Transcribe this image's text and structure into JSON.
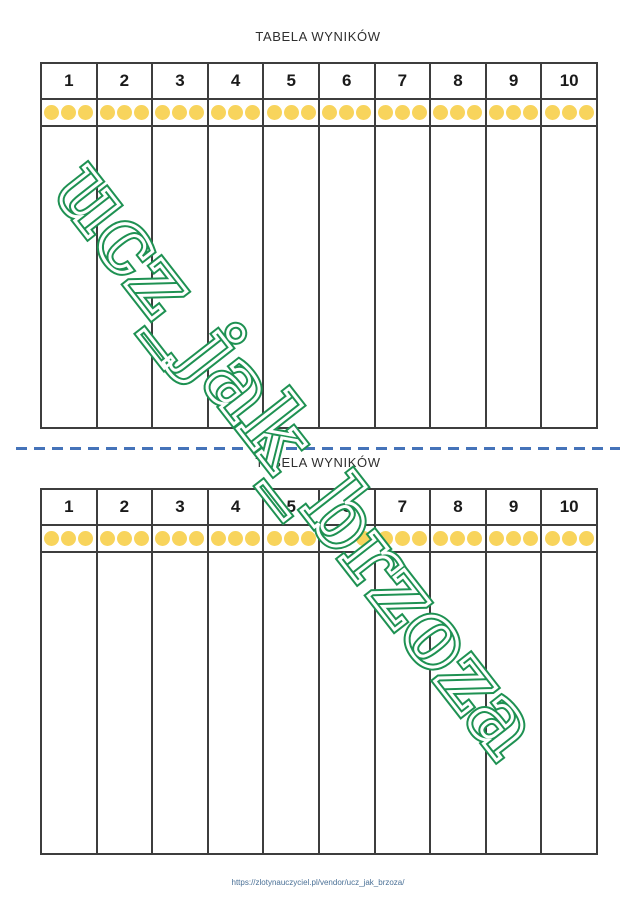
{
  "sections": [
    {
      "title": "TABELA WYNIKÓW"
    },
    {
      "title": "TABELA WYNIKÓW"
    }
  ],
  "table": {
    "columns": [
      "1",
      "2",
      "3",
      "4",
      "5",
      "6",
      "7",
      "8",
      "9",
      "10"
    ],
    "dots_per_cell": 3
  },
  "watermark": {
    "text": "ucz_jak_brzoza"
  },
  "footer": {
    "url": "https://zlotynauczyciel.pl/vendor/ucz_jak_brzoza/"
  },
  "colors": {
    "dot": "#F8D45C",
    "divider": "#4573B9",
    "border": "#3d3d3d",
    "watermark": "#1e9152",
    "url_text": "#4a7096"
  }
}
